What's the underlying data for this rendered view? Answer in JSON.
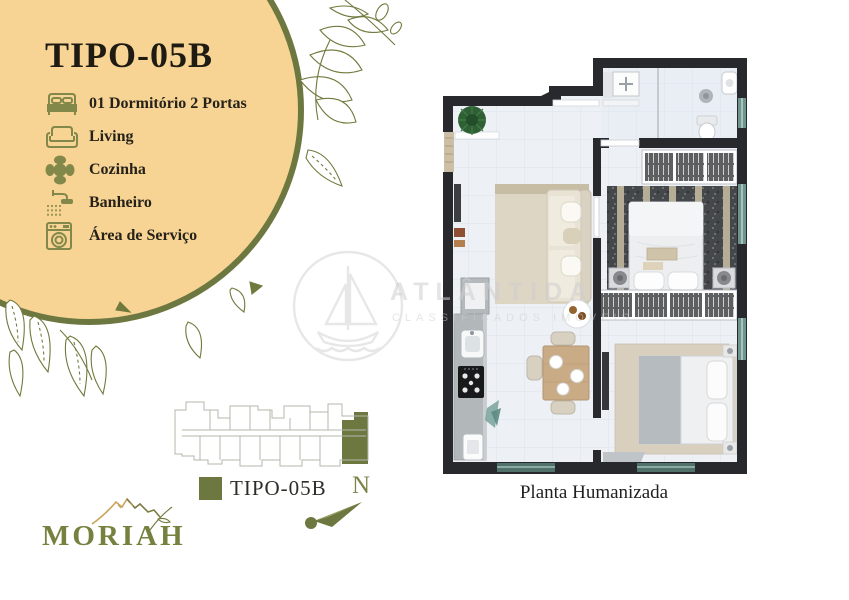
{
  "panel": {
    "title": "TIPO-05B",
    "legend": [
      {
        "icon": "bed-icon",
        "label": "01 Dormitório 2 Portas"
      },
      {
        "icon": "sofa-icon",
        "label": "Living"
      },
      {
        "icon": "dining-table-icon",
        "label": "Cozinha"
      },
      {
        "icon": "shower-icon",
        "label": "Banheiro"
      },
      {
        "icon": "washing-machine-icon",
        "label": "Área de Serviço"
      }
    ]
  },
  "unit_key": {
    "label": "TIPO-05B"
  },
  "compass": {
    "north_label": "N"
  },
  "logo": {
    "brand": "MORIAH"
  },
  "plan": {
    "caption": "Planta Humanizada"
  },
  "watermark": {
    "title": "ATLÂNTIDA",
    "subtitle": "CLASSIFICADOS IMÓVEIS"
  },
  "colors": {
    "circle_fill": "#f7d494",
    "accent_olive": "#6d7840",
    "icon_olive": "#82884a",
    "logo_green": "#76803f",
    "mountain_gold": "#c9a45a",
    "plan_wall": "#27292c",
    "plan_floor": "#edf1f6",
    "window_teal": "#6f948d"
  }
}
